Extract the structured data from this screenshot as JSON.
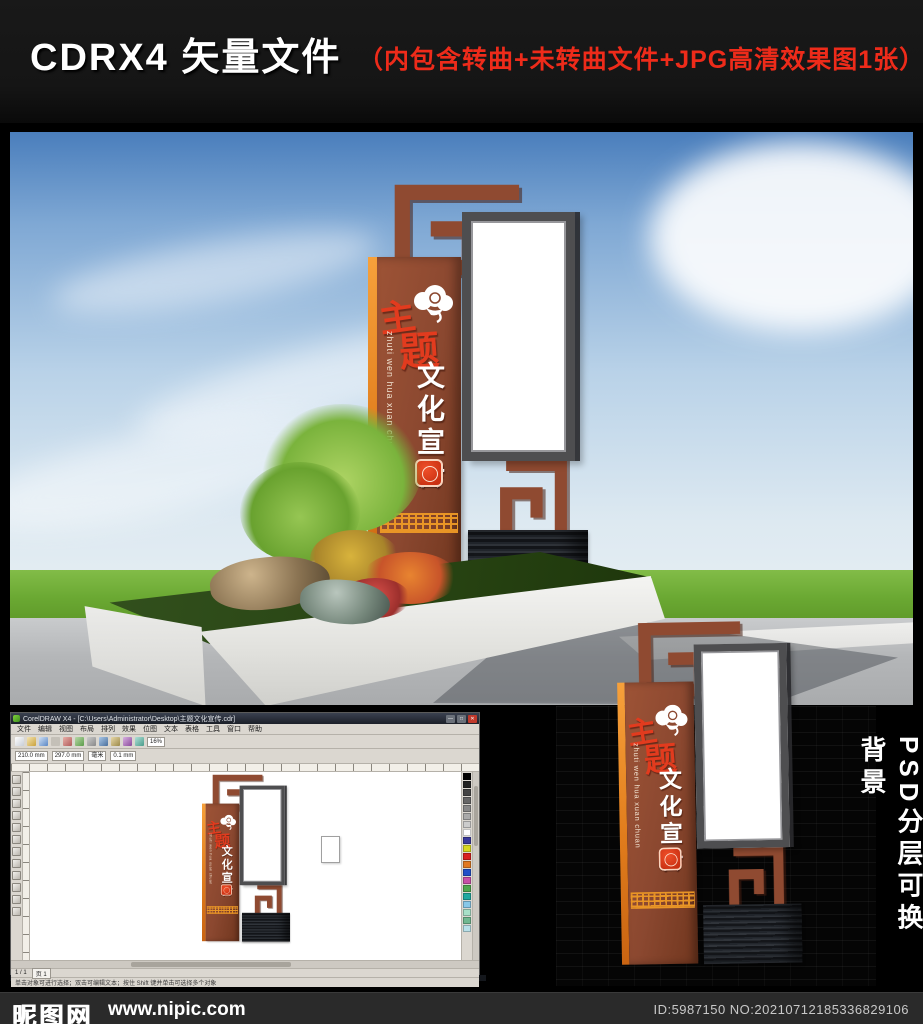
{
  "header": {
    "title": "CDRX4 矢量文件",
    "subtitle": "（内包含转曲+未转曲文件+JPG高清效果图1张）"
  },
  "sign": {
    "title_char1": "主",
    "title_char2": "题",
    "vertical_text": "文化宣传",
    "pinyin": "zhuti wen hua xuan chuan"
  },
  "side_note": "PSD分层可换背景",
  "coreldraw": {
    "title": "CorelDRAW X4 - [C:\\Users\\Administrator\\Desktop\\主题文化宣传.cdr]",
    "menus": [
      "文件",
      "编辑",
      "视图",
      "布局",
      "排列",
      "效果",
      "位图",
      "文本",
      "表格",
      "工具",
      "窗口",
      "帮助"
    ],
    "window_buttons": [
      "—",
      "□",
      "✕"
    ],
    "prop_width": "210.0 mm",
    "prop_height": "297.0 mm",
    "prop_units": "毫米",
    "prop_nudge": "0.1 mm",
    "zoom_level": "16%",
    "page_indicator": "1 / 1",
    "page_tab": "页 1",
    "status_hint": "单击对象可进行选择；双击可编辑文本；按住 Shift 键并单击可选择多个对象"
  },
  "footer": {
    "site_name": "昵图网",
    "site_url": "www.nipic.com",
    "image_id": "ID:5987150 NO:20210712185336829106"
  },
  "colors": {
    "accent_red": "#ee2b1a",
    "sign_brown": "#8b4830",
    "sign_orange": "#e07c1c",
    "sky_blue": "#4a7ebc",
    "grass_green": "#6aa832",
    "footer_bg": "#2a2a2a"
  }
}
